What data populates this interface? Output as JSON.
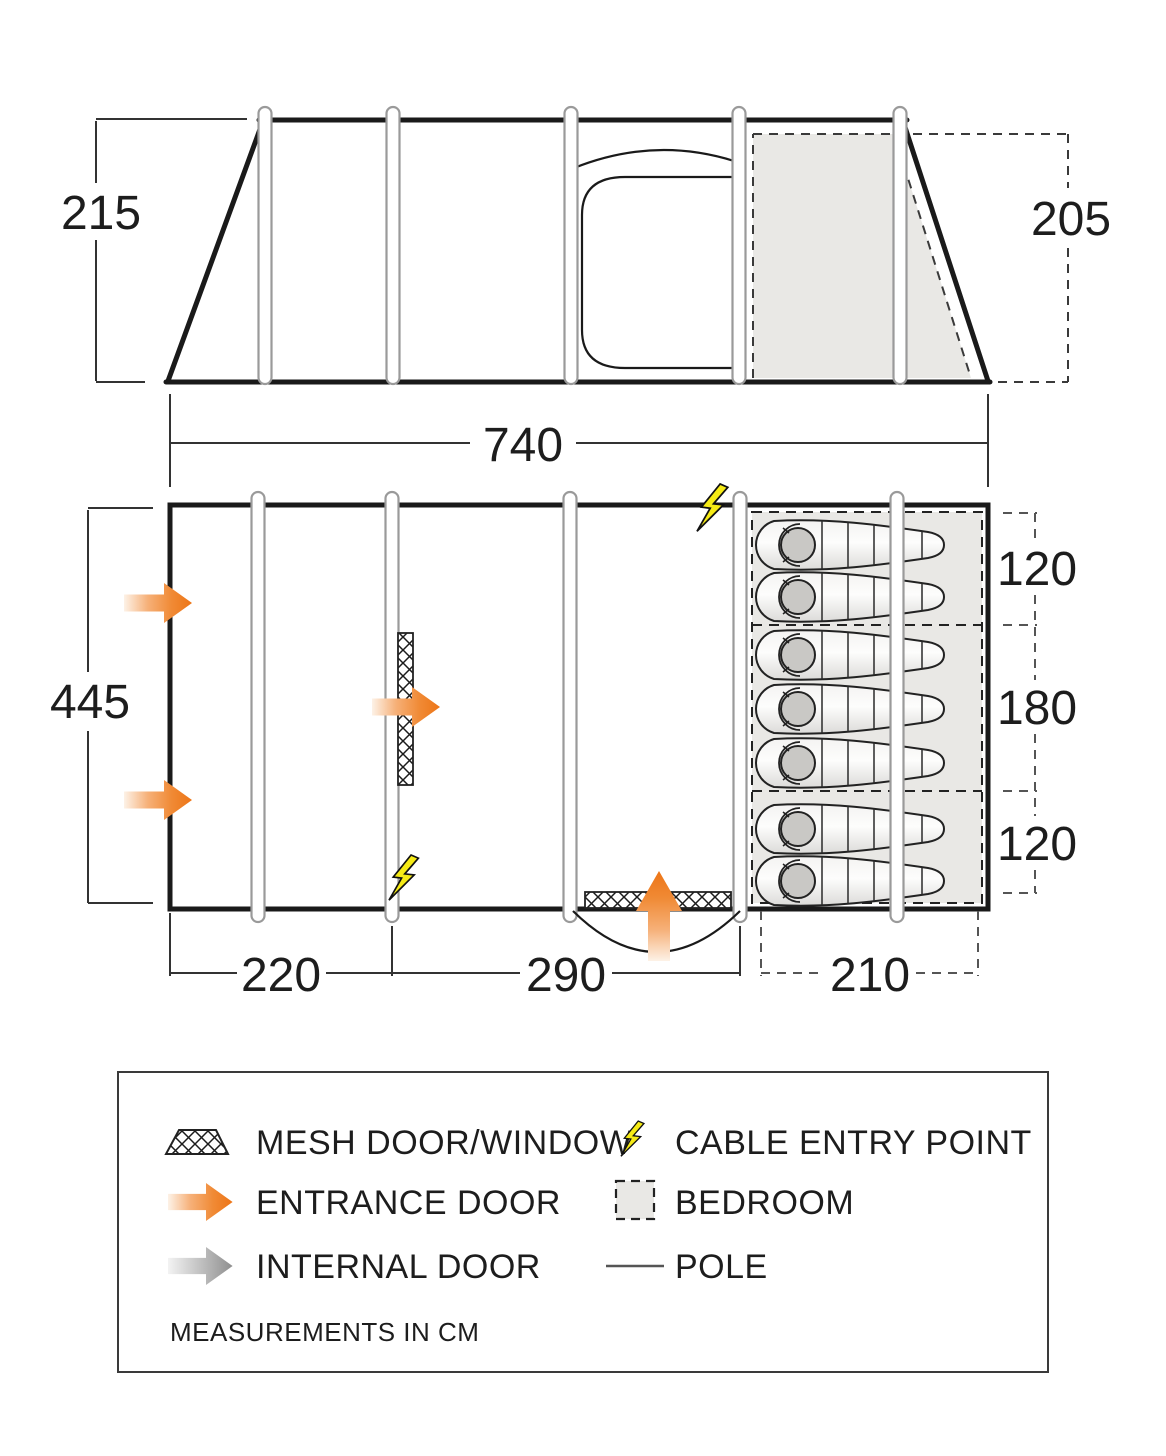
{
  "diagram_title": "tent-floorplan-and-elevation",
  "units_note": "MEASUREMENTS IN CM",
  "side_view": {
    "height_left_cm": "215",
    "height_right_cm": "205",
    "length_cm": "740",
    "pole_xs": [
      265,
      393,
      571,
      739,
      900
    ]
  },
  "floorplan": {
    "depth_cm": "445",
    "bedroom_section_depths_cm": [
      "120",
      "180",
      "120"
    ],
    "bottom_widths_cm": [
      "220",
      "290",
      "210"
    ],
    "pole_xs": [
      258,
      392,
      570,
      740,
      897
    ],
    "sleeping_bag_rows_y": [
      545,
      597,
      655,
      709,
      763,
      829,
      881
    ],
    "sleeping_bag_count": 7
  },
  "legend": {
    "items": [
      {
        "icon": "mesh-swatch-icon",
        "label": "MESH DOOR/WINDOW"
      },
      {
        "icon": "lightning-icon",
        "label": "CABLE ENTRY POINT"
      },
      {
        "icon": "entrance-arrow-icon",
        "label": "ENTRANCE DOOR"
      },
      {
        "icon": "bedroom-swatch-icon",
        "label": "BEDROOM"
      },
      {
        "icon": "internal-arrow-icon",
        "label": "INTERNAL DOOR"
      },
      {
        "icon": "pole-line-icon",
        "label": "POLE"
      }
    ],
    "note": "MEASUREMENTS IN CM"
  },
  "colors": {
    "entrance_orange": "#ee7c23",
    "internal_gray": "#969696",
    "cable_yellow": "#f6eb16",
    "bedroom_fill": "#e9e8e5",
    "outline_black": "#1a1a1a",
    "pole_stroke": "#9a9a9a"
  }
}
